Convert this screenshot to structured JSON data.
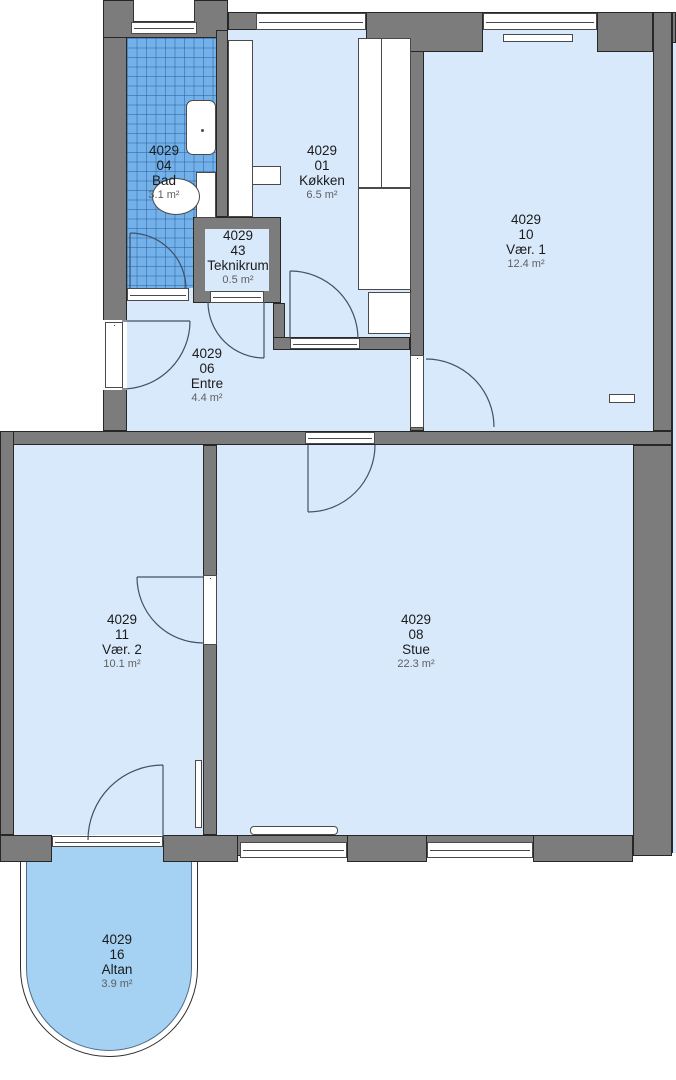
{
  "plan": {
    "unit_number": "4029",
    "rooms": [
      {
        "key": "bad",
        "unit": "4029",
        "number": "04",
        "name": "Bad",
        "area": "3.1 m²"
      },
      {
        "key": "kokken",
        "unit": "4029",
        "number": "01",
        "name": "Køkken",
        "area": "6.5 m²"
      },
      {
        "key": "teknikrum",
        "unit": "4029",
        "number": "43",
        "name": "Teknikrum",
        "area": "0.5 m²"
      },
      {
        "key": "vaer1",
        "unit": "4029",
        "number": "10",
        "name": "Vær. 1",
        "area": "12.4 m²"
      },
      {
        "key": "entre",
        "unit": "4029",
        "number": "06",
        "name": "Entre",
        "area": "4.4 m²"
      },
      {
        "key": "vaer2",
        "unit": "4029",
        "number": "11",
        "name": "Vær. 2",
        "area": "10.1 m²"
      },
      {
        "key": "stue",
        "unit": "4029",
        "number": "08",
        "name": "Stue",
        "area": "22.3 m²"
      },
      {
        "key": "altan",
        "unit": "4029",
        "number": "16",
        "name": "Altan",
        "area": "3.9 m²"
      }
    ],
    "colors": {
      "wall": "#7c7c7c",
      "room_fill": "#d8e9fc",
      "bath_tile": "#72b1e9",
      "balcony_fill": "#a5d1f2",
      "outline": "#272727",
      "door_swing": "#3f5169"
    }
  }
}
